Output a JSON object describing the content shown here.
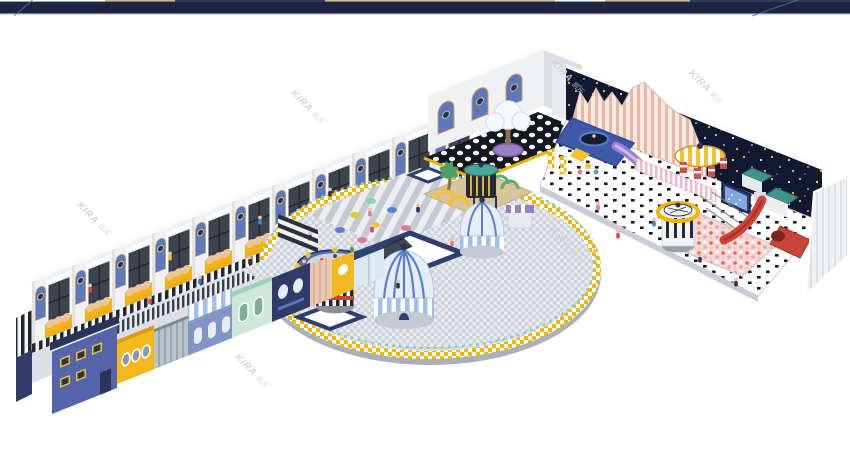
{
  "watermark": {
    "text": "KIRA 凯乐",
    "brand": "KIRA",
    "suffix": "凯乐",
    "color": "#cdd0d5",
    "rotation_deg": 45,
    "instances": [
      {
        "x": 296,
        "y": 88
      },
      {
        "x": 556,
        "y": 58
      },
      {
        "x": 694,
        "y": 68
      },
      {
        "x": 82,
        "y": 200
      },
      {
        "x": 240,
        "y": 352
      },
      {
        "x": 554,
        "y": 226
      }
    ]
  },
  "top_bar": {
    "color": "#1d2542",
    "height": 14,
    "bottom_line_color": "#9a9fb2",
    "diagonal_line_color": "#5f74ad",
    "sliver_segments": [
      {
        "x": 105,
        "w": 70,
        "color": "#c9b98a"
      },
      {
        "x": 175,
        "w": 150,
        "color": "#323a58"
      },
      {
        "x": 325,
        "w": 230,
        "color": "#cdbd8f"
      },
      {
        "x": 555,
        "w": 50,
        "color": "#f5f5f2"
      },
      {
        "x": 605,
        "w": 85,
        "color": "#c9b98a"
      },
      {
        "x": 690,
        "w": 160,
        "color": "#323a58"
      }
    ]
  },
  "palette": {
    "navy": "#2b3358",
    "archBlue": "#5b77c0",
    "glass": "#3e444e",
    "benchYellow": "#f2b40f",
    "seatPeach": "#edc39c",
    "stripeDark": "#232732",
    "walkGray": "#dce0e6",
    "shopBlue": "#5565ab",
    "shopYellow": "#f3b81d",
    "shopSlate": "#8095c5",
    "shopMint": "#cde8da",
    "shopNavy": "#2f3c68",
    "canopyBlue": "#9fc0e8",
    "circleFloorA": "#e9ebef",
    "circleFloorB": "#ccd2da",
    "fenceYellow": "#f2b705",
    "railMint": "#7fd0b4",
    "trampNavy": "#2e3f6e",
    "carouselBlue": "#4a6bb5",
    "domeBlue": "#5b7fd0",
    "domeLight": "#e7edf7",
    "palmGreen": "#4a9e68",
    "woodTan": "#d9c49a",
    "towerDark": "#23283a",
    "towerTeal": "#4aa89a",
    "nightWall": "#121830",
    "starYellow": "#f2c230",
    "wavyCream": "#f6ead9",
    "wavyPink": "#e8b4ad",
    "platformBlue": "#3d59a8",
    "slidePurple": "#9a7fd0",
    "candyPink": "#f0b8c8",
    "screenBlue": "#2b3a6e",
    "screenFace": "#7fa8e0",
    "ballpitBase": "#f5d9d4",
    "slideRed": "#cc4438",
    "tealRoof": "#3f948e",
    "wallRidge": "#eef0f2",
    "shadow": "#aab0b9",
    "wallWhite": "#f0f1f3"
  }
}
